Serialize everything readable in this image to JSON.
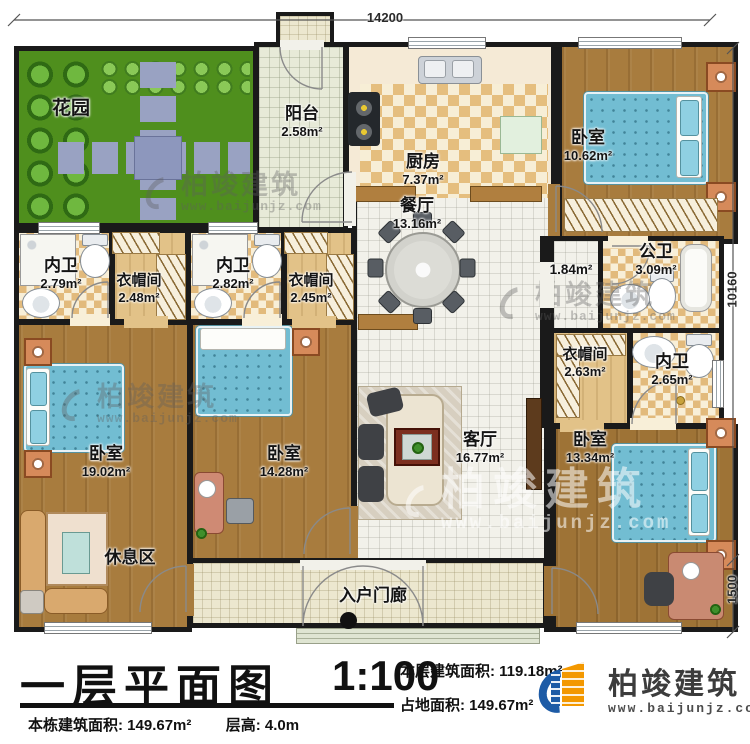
{
  "rooms": {
    "garden": {
      "name": "花园"
    },
    "balcony": {
      "name": "阳台",
      "area": "2.58m²"
    },
    "kitchen": {
      "name": "厨房",
      "area": "7.37m²"
    },
    "dining": {
      "name": "餐厅",
      "area": "13.16m²"
    },
    "bedroom_top_right": {
      "name": "卧室",
      "area": "10.62m²"
    },
    "hallway": {
      "area": "1.84m²"
    },
    "public_bath": {
      "name": "公卫",
      "area": "3.09m²"
    },
    "cloak_right": {
      "name": "衣帽间",
      "area": "2.63m²"
    },
    "bath_right": {
      "name": "内卫",
      "area": "2.65m²"
    },
    "bath_left1": {
      "name": "内卫",
      "area": "2.79m²"
    },
    "cloak_left1": {
      "name": "衣帽间",
      "area": "2.48m²"
    },
    "bath_left2": {
      "name": "内卫",
      "area": "2.82m²"
    },
    "cloak_left2": {
      "name": "衣帽间",
      "area": "2.45m²"
    },
    "bedroom_bottom_left": {
      "name": "卧室",
      "area": "19.02m²"
    },
    "rest_area": {
      "name": "休息区"
    },
    "bedroom_bottom_mid": {
      "name": "卧室",
      "area": "14.28m²"
    },
    "living": {
      "name": "客厅",
      "area": "16.77m²"
    },
    "bedroom_bottom_right": {
      "name": "卧室",
      "area": "13.34m²"
    },
    "porch": {
      "name": "入户门廊"
    }
  },
  "dimensions": {
    "top_width": "14200",
    "right_height": "10160",
    "porch_depth": "1500"
  },
  "title_block": {
    "title": "一层平面图",
    "scale": "1:100",
    "floor_area_label": "本层建筑面积:",
    "floor_area_value": "119.18m²",
    "land_area_label": "占地面积:",
    "land_area_value": "149.67m²",
    "building_area_label": "本栋建筑面积:",
    "building_area_value": "149.67m²",
    "storey_height_label": "层高:",
    "storey_height_value": "4.0m"
  },
  "brand": {
    "name": "柏竣建筑",
    "url": "www.baijunjz.com"
  },
  "watermark": {
    "name": "柏竣建筑",
    "url": "www.baijunjz.com"
  },
  "colors": {
    "wall": "#1a1a1a",
    "grass": "#4f8f1d",
    "wood": "#a87c3e",
    "bed": "#72bdd2",
    "logo_blue": "#1d5ba6",
    "logo_orange": "#f39800"
  }
}
